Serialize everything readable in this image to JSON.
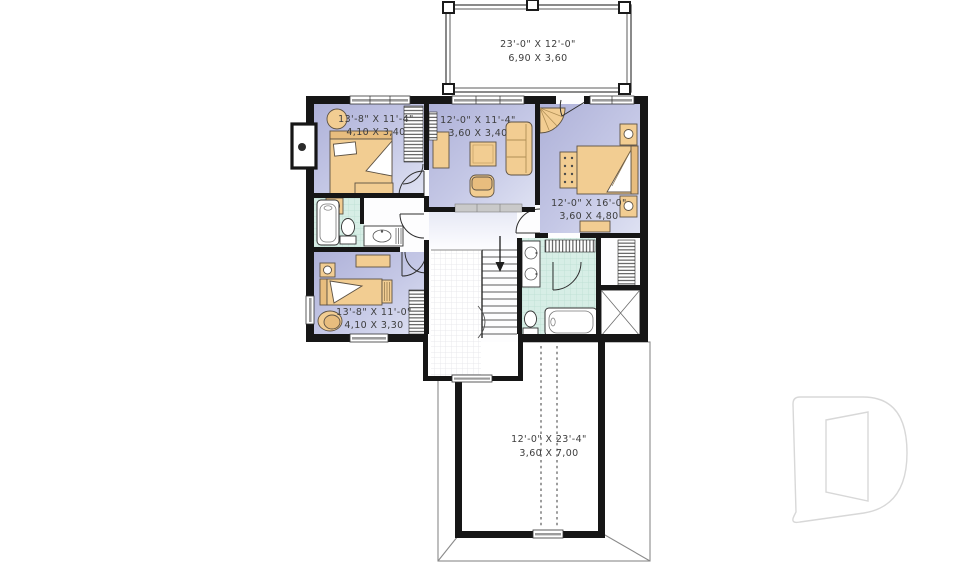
{
  "labels": {
    "deck": {
      "imperial": "23'-0\" X 12'-0\"",
      "metric": "6,90 X 3,60"
    },
    "bedroom_top_left": {
      "imperial": "13'-8\" X 11'-4\"",
      "metric": "4,10 X 3,40"
    },
    "sitting_room": {
      "imperial": "12'-0\" X 11'-4\"",
      "metric": "3,60 X 3,40"
    },
    "master_bedroom": {
      "imperial": "12'-0\" X 16'-0\"",
      "metric": "3,60 X 4,80"
    },
    "bedroom_bottom_left": {
      "imperial": "13'-8\" X 11'-0\"",
      "metric": "4,10 X 3,30"
    },
    "garage_below": {
      "imperial": "12'-0\" X 23'-4\"",
      "metric": "3,60 X 7,00"
    }
  },
  "colors": {
    "wall": "#161616",
    "room_fill_dark": "#b0b3d9",
    "room_fill_light": "#dbdef1",
    "bath_tile": "#d7eee6",
    "furniture_tan": "#f2cd92",
    "watermark_gray": "#d8d8d8"
  },
  "icons": [
    "bed-icon",
    "sofa-icon",
    "armchair-icon",
    "table-icon",
    "dresser-icon",
    "nightstand-icon",
    "bathtub-icon",
    "toilet-icon",
    "sink-icon",
    "double-sink-icon",
    "shower-icon",
    "stairs-icon",
    "down-arrow-icon",
    "closet-hatch-icon",
    "chimney-icon",
    "drummond-d-logo"
  ]
}
